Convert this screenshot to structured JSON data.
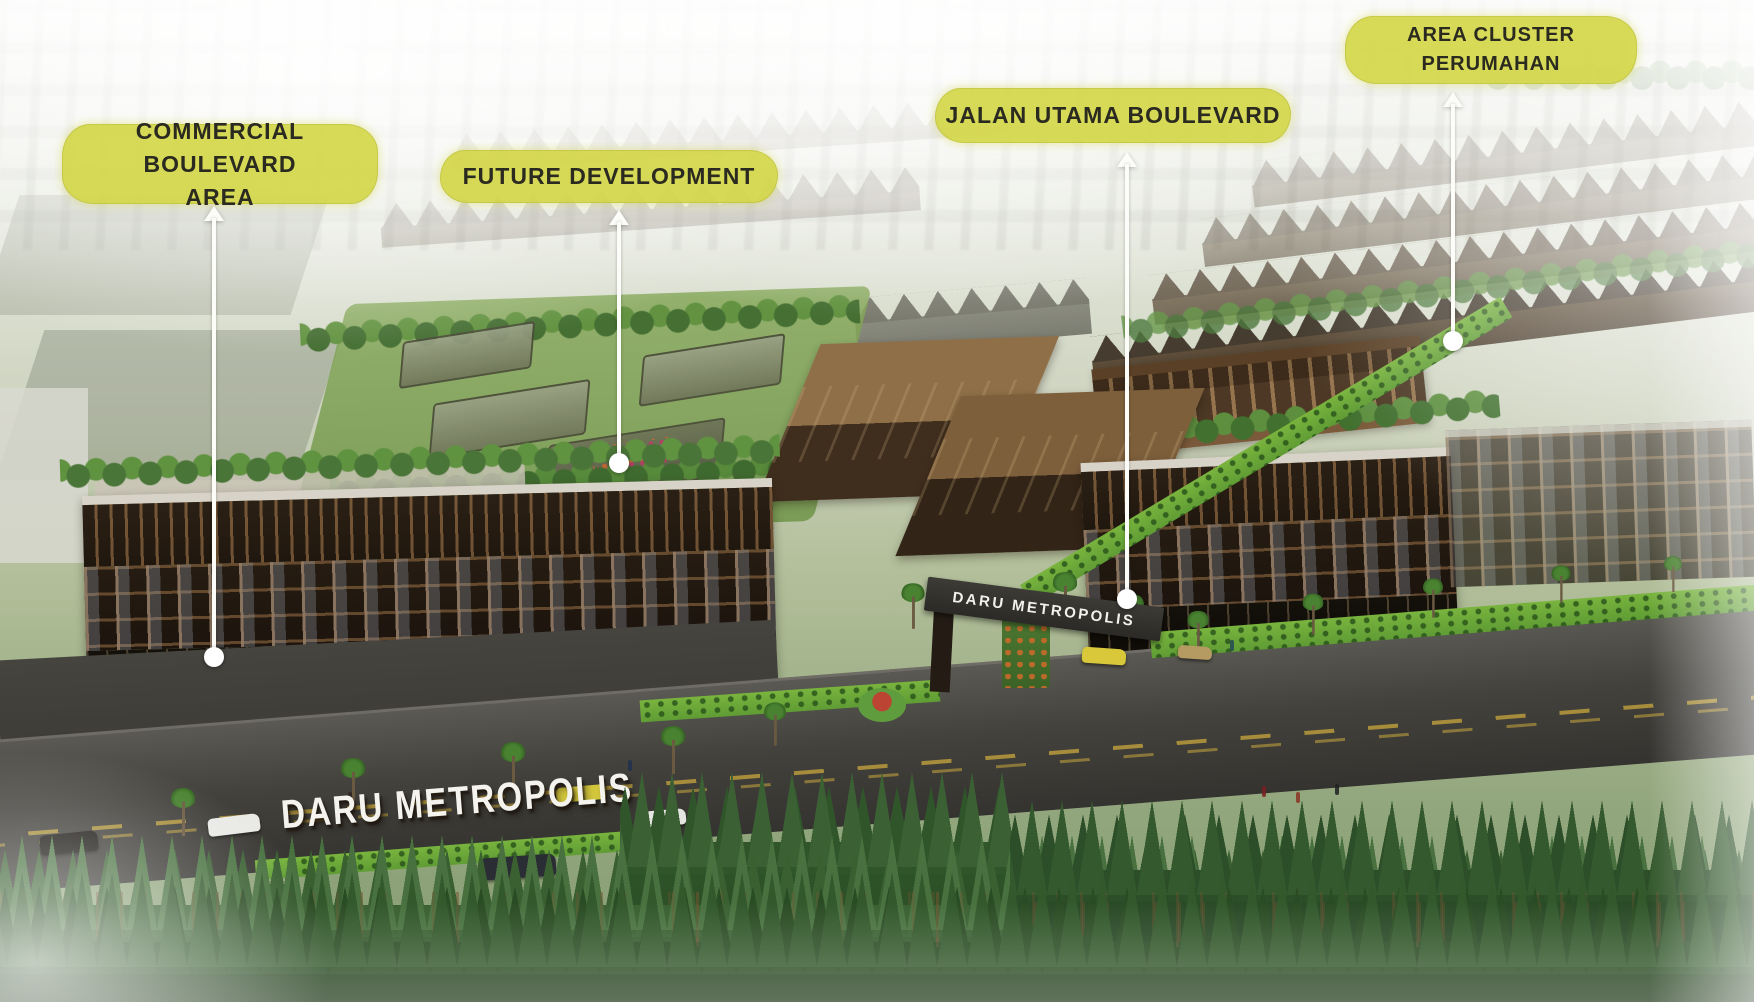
{
  "callouts": [
    {
      "id": "commercial-boulevard-area",
      "line1": "COMMERCIAL BOULEVARD",
      "line2": "AREA"
    },
    {
      "id": "future-development",
      "line1": "FUTURE DEVELOPMENT",
      "line2": ""
    },
    {
      "id": "jalan-utama-boulevard",
      "line1": "JALAN UTAMA BOULEVARD",
      "line2": ""
    },
    {
      "id": "area-cluster-perumahan",
      "line1": "AREA CLUSTER",
      "line2": "PERUMAHAN"
    }
  ],
  "scene": {
    "entrance_sign": "DARU METROPOLIS",
    "gate_sign": "DARU METROPOLIS"
  },
  "colors": {
    "callout_fill": "#d3d645",
    "callout_text": "#2b2a20",
    "pointer_line": "#fcfcf9",
    "haze": "#ffffff",
    "building_dark": "#241b12",
    "building_roof_brown": "#8f6f47",
    "greenery": "#4e7a3e",
    "hedge_bright": "#79b43e"
  }
}
